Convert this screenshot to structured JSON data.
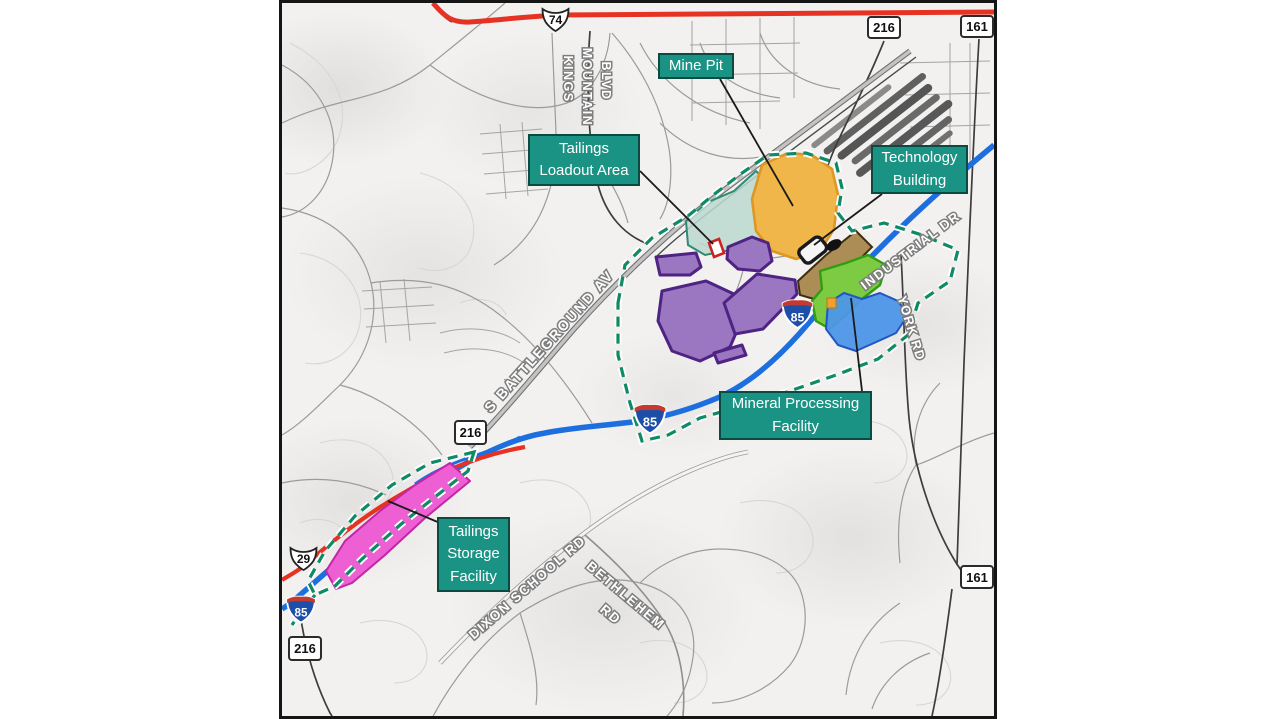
{
  "map": {
    "callouts": {
      "mine_pit": {
        "line1": "Mine Pit"
      },
      "tailings_loadout": {
        "line1": "Tailings",
        "line2": "Loadout Area"
      },
      "technology_building": {
        "line1": "Technology",
        "line2": "Building"
      },
      "mineral_processing": {
        "line1": "Mineral Processing",
        "line2": "Facility"
      },
      "tailings_storage": {
        "line1": "Tailings",
        "line2": "Storage",
        "line3": "Facility"
      }
    },
    "road_labels": {
      "kings": "KINGS",
      "mountain": "MOUNTAIN",
      "blvd": "BLVD",
      "battleground": "S BATTLEGROUND AV",
      "industrial": "INDUSTRIAL DR",
      "york": "YORK RD",
      "dixon": "DIXON SCHOOL RD",
      "bethlehem": "BETHLEHEM",
      "bethlehem_rd": "RD"
    },
    "shields": {
      "us74": "74",
      "us29": "29",
      "i85": "85",
      "r216": "216",
      "r161": "161"
    },
    "colors": {
      "callout_bg": "#1b9384",
      "callout_border": "#0b4a40",
      "project_boundary": "#0f8a66",
      "mine_pit_fill": "#f1b64a",
      "loadout_fill": "#bcd9cf",
      "purple_fill": "#9a77c0",
      "brown_fill": "#ac8d55",
      "green_fill": "#7ccb42",
      "blue_area_fill": "#4d96e8",
      "pink_fill": "#ee5fd3",
      "interstate_blue": "#1d6fe0",
      "highway_red": "#e63222"
    }
  }
}
